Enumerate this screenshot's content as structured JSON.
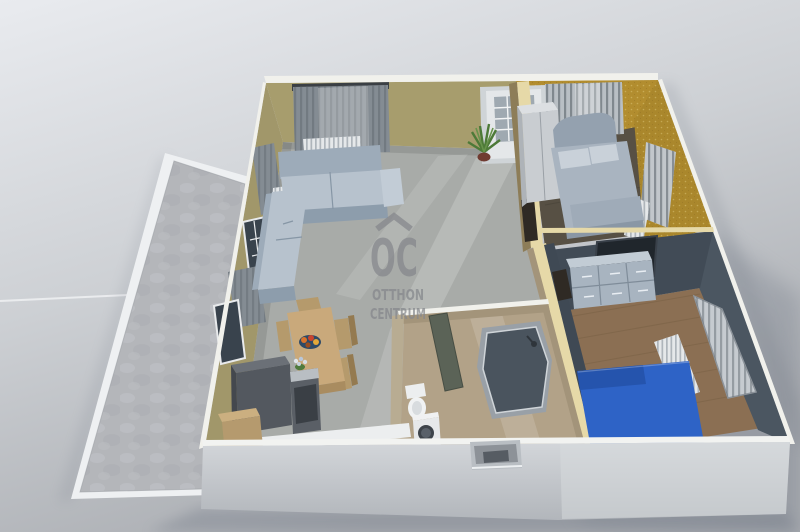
{
  "watermark": {
    "logo_text": "OC",
    "line1": "OTTHON",
    "line2": "CENTRUM"
  },
  "colors": {
    "background_top": "#e7e9ed",
    "background_bottom": "#a9acb1",
    "terrace_frame": "#eef0f2",
    "terrace_floor": "#b4b6ba",
    "wall_olive": "#a79d6d",
    "wall_olive_side": "#a1976a",
    "wall_gold": "#b28d2f",
    "wall_gold_side": "#aa872c",
    "wall_slate": "#4b5661",
    "wall_slate_dark": "#414b56",
    "wall_top_white": "#f1f1ec",
    "wall_top_yellow": "#e6d9a8",
    "divider_wood": "#8d7d58",
    "floor_living": "#a8aba8",
    "floor_bath": "#b2a288",
    "floor_bed1": "#575044",
    "floor_bed2": "#8b6f53",
    "front_wall": "#c9cdd1",
    "front_wall_top": "#f2f3f1",
    "sofa": "#b7c2cd",
    "sofa_back": "#9dabb9",
    "bed1": "#a9b4c0",
    "bed2": "#2e63c6",
    "wood_furniture": "#c9a97b",
    "appliance_dark": "#53585f",
    "appliance_white": "#e6e8ea",
    "dresser": "#a8b4c0",
    "tv": "#20262c",
    "shower_glass": "#4a545e",
    "curtain": "#848c93",
    "radiator": "#e5e8ea",
    "plant": "#4d7a38",
    "bed2_blue_dark": "#2554ad",
    "watermark": "#85878c"
  }
}
